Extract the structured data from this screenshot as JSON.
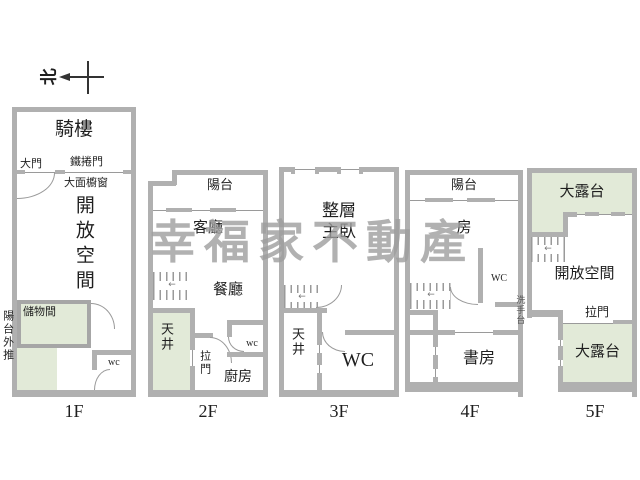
{
  "colors": {
    "wall": "#b0b0b0",
    "line": "#9a9a9a",
    "green_area": "#e2ead8",
    "text": "#1f1f1f",
    "watermark": "#9e9e9e"
  },
  "icons": {
    "stair_direction_arrow": "←"
  },
  "compass": {
    "north": "北"
  },
  "watermark": {
    "text": "幸福家不動產"
  },
  "floors": {
    "f1": {
      "name": "1F",
      "arcade": "騎樓",
      "main_door": "大門",
      "roller_door": "鐵捲門",
      "display_window": "大面櫥窗",
      "open_space": "開放空間",
      "storage": "儲物間",
      "balcony_extension": "陽台外推",
      "wc": "wc"
    },
    "f2": {
      "name": "2F",
      "balcony": "陽台",
      "living_room": "客廳",
      "dining_room": "餐廳",
      "light_well": "天井",
      "sliding_door": "拉門",
      "kitchen": "廚房",
      "wc": "wc"
    },
    "f3": {
      "name": "3F",
      "master_line1": "整層",
      "master_line2": "主臥",
      "light_well": "天井",
      "wc": "WC"
    },
    "f4": {
      "name": "4F",
      "balcony": "陽台",
      "room": "房",
      "wc": "WC",
      "study": "書房"
    },
    "f5": {
      "name": "5F",
      "terrace_top": "大露台",
      "open_space": "開放空間",
      "washbasin": "洗手台",
      "sliding_door": "拉門",
      "terrace_bottom": "大露台"
    }
  }
}
